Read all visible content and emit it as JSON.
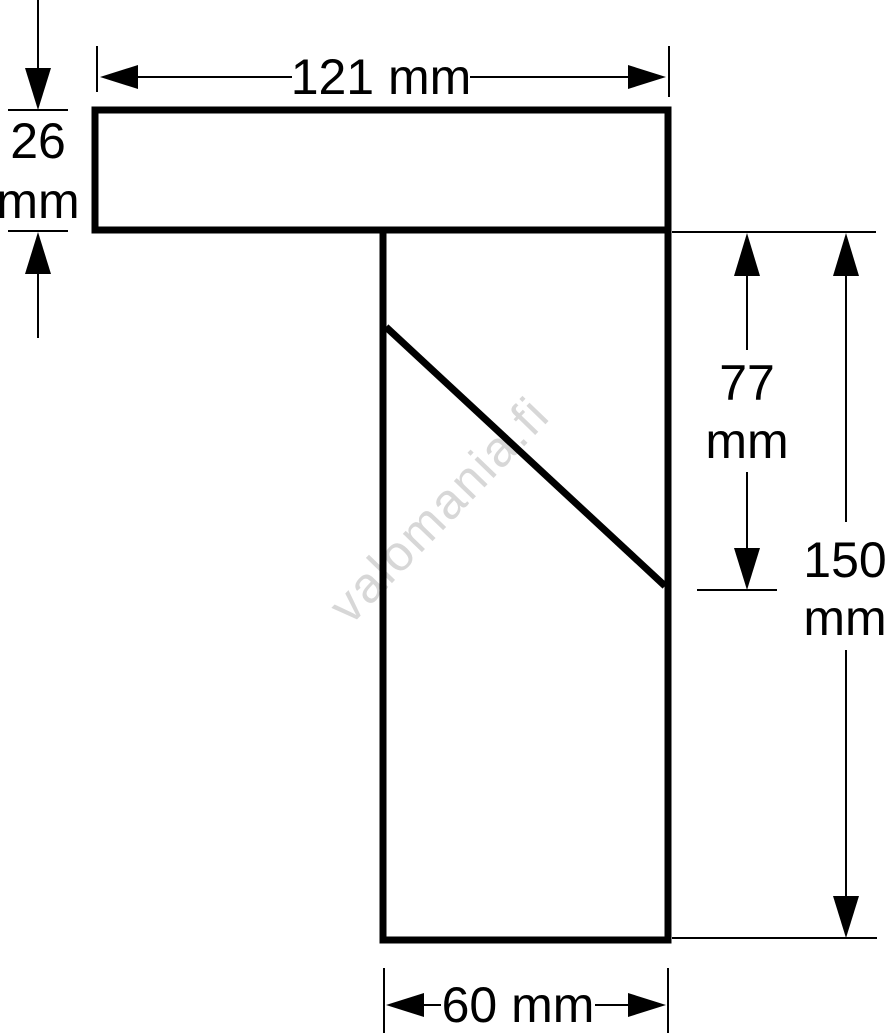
{
  "diagram": {
    "type": "technical-drawing-profile-cross-section",
    "watermark": "valomania.fi",
    "colors": {
      "outline": "#000000",
      "dimension_lines": "#000000",
      "background": "#ffffff",
      "watermark": "#d7d7d7"
    },
    "labels": {
      "flange_width": "121 mm",
      "flange_thickness_value": "26",
      "flange_thickness_unit": "mm",
      "web_upper_value": "77",
      "web_upper_unit": "mm",
      "total_height_value": "150",
      "total_height_unit": "mm",
      "web_width": "60 mm"
    }
  }
}
